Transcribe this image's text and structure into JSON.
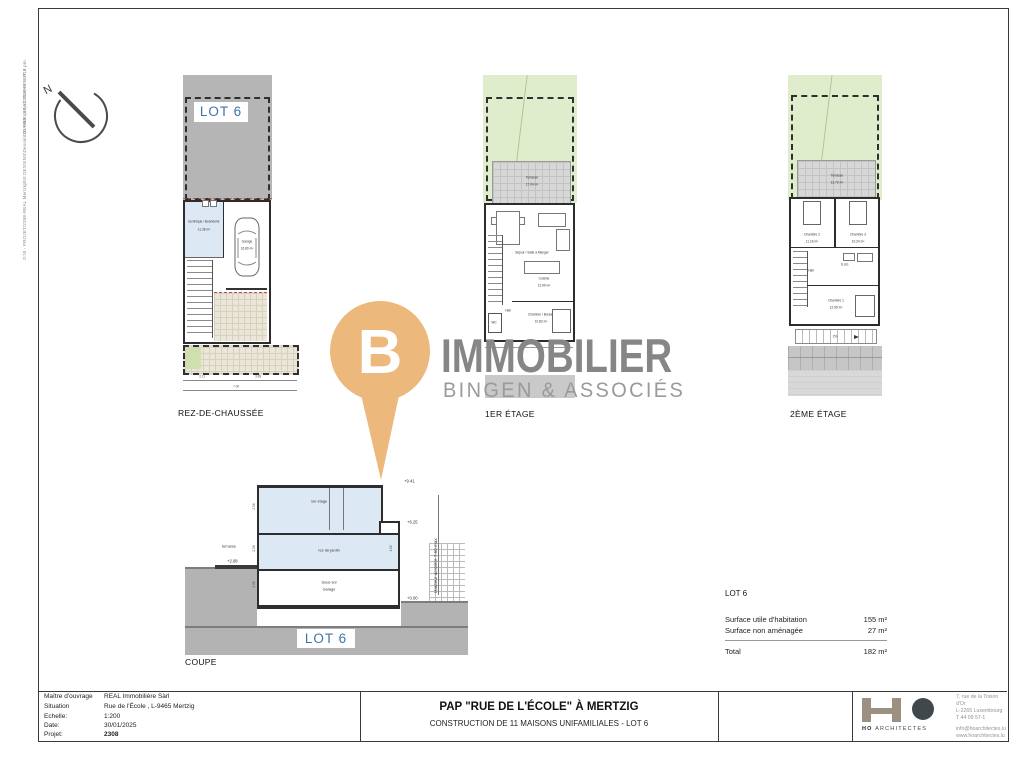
{
  "sheet": {
    "path_label_upper": "03 PRE / 03.12 PLANS LOT 6",
    "path_label_lower": "O:\\0 - PROJET\\2308-REAL Mertzig\\03 DESSINS\\Dessin\\03-Avant-projet\\2308-APS-A13 pm"
  },
  "north": {
    "label": "N"
  },
  "watermark": {
    "letter": "B",
    "name": "IMMOBILIER",
    "tagline": "BINGEN & ASSOCIÉS",
    "pin_color": "#edb87c",
    "name_color": "#868686"
  },
  "plan_rdc": {
    "caption": "REZ-DE-CHAUSSÉE",
    "lot_label": "LOT 6",
    "room_tech": "technique / Buanderie",
    "room_tech_area": "11.38 m²",
    "room_garage": "Garage",
    "room_garage_area": "16.80 m²",
    "dim_left": "3.11",
    "dim_right": "3.89",
    "dim_total": "7.00"
  },
  "plan_e1": {
    "caption": "1ER ÉTAGE",
    "terrasse": "Terrasse",
    "terrasse_area": "17.64 m²",
    "sejour": "Séjour / Salle à Manger",
    "cuisine": "Cuisine",
    "cuisine_area": "12.99 m²",
    "hall": "Hall",
    "wc": "WC",
    "chambre": "Chambre / Bureau",
    "chambre_area": "10.82 m²"
  },
  "plan_e2": {
    "caption": "2ÈME ÉTAGE",
    "terrasse": "Terrasse",
    "terrasse_area": "13.72 m²",
    "chambre2": "Chambre 2",
    "chambre2_area": "11.16 m²",
    "chambre3": "Chambre 3",
    "chambre3_area": "10.24 m²",
    "sdb": "S.d.b.",
    "hall": "Hall",
    "chambre1": "Chambre 1",
    "chambre1_area": "12.95 m²",
    "ramp": "2%"
  },
  "coupe": {
    "caption": "COUPE",
    "lot_label": "LOT 6",
    "floor_top": "1er étage",
    "floor_mid": "rez-de-jardin",
    "floor_bottom_1": "Sous-sol",
    "floor_bottom_2": "Garage",
    "terrasse": "terrasse",
    "lvl_top": "+9.41",
    "lvl_mid": "+6.25",
    "lvl_terr": "+2.98",
    "lvl_zero": "+0.00",
    "height_note": "Hauteur acrotère 7.50 max",
    "dim_1": "2.56",
    "dim_2": "2.58",
    "dim_3": "2.88",
    "dim_4": "1.00"
  },
  "surfaces": {
    "title": "LOT 6",
    "row1_label": "Surface utile d'habitation",
    "row1_value": "155 m²",
    "row2_label": "Surface non aménagée",
    "row2_value": "27 m²",
    "total_label": "Total",
    "total_value": "182 m²"
  },
  "titleblock": {
    "rows": [
      {
        "label": "Maître d'ouvrage",
        "value": "REAL Immobilière Sàrl"
      },
      {
        "label": "Situation",
        "value": "Rue de l'École , L-9465 Mertzig"
      },
      {
        "label": "Echelle:",
        "value": "1:200"
      },
      {
        "label": "Date:",
        "value": "30/01/2025"
      },
      {
        "label": "Projet:",
        "value": "2308"
      }
    ],
    "title": "PAP \"RUE DE L'ÉCOLE\" À MERTZIG",
    "subtitle": "CONSTRUCTION DE 11 MAISONS UNIFAMILIALES - LOT 6",
    "logo_ho": "HO",
    "logo_rest": "ARCHITECTES",
    "addr1": "7, rue de la Toison d'Or",
    "addr2": "L-2265 Luxembourg",
    "addr3": "T 44 09 57-1",
    "addr4": "info@hoarchitectes.lu",
    "addr5": "www.hoarchitectes.lu"
  }
}
